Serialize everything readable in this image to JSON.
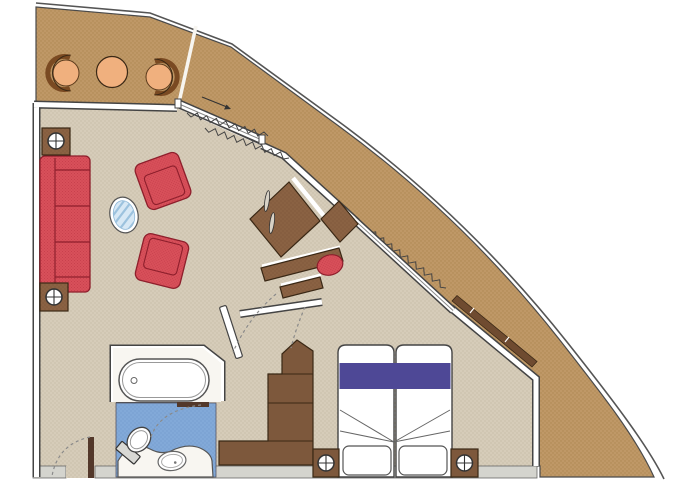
{
  "plan": {
    "kind": "cruise-ship-suite-floor-plan",
    "areas": [
      "balcony",
      "living-room",
      "bedroom",
      "bathroom",
      "entry"
    ],
    "inventory": [
      "balcony-chair",
      "balcony-chair",
      "balcony-table",
      "sofa",
      "end-table",
      "end-table",
      "armchair",
      "armchair",
      "coffee-table",
      "sliding-glass-door",
      "curtains",
      "window",
      "window-sill",
      "tv-cabinet",
      "side-cabinet",
      "desk",
      "desk-stool",
      "interior-door",
      "wardrobe",
      "bathtub",
      "toilet",
      "washbasin",
      "vanity-counter",
      "bathroom-door",
      "double-bed",
      "pillow",
      "pillow",
      "nightstand",
      "nightstand",
      "entry-door",
      "lamp-symbol",
      "lamp-symbol",
      "lamp-symbol",
      "lamp-symbol"
    ]
  },
  "colors": {
    "page_bg": "#FFFFFF",
    "hull": "#BF9867",
    "hull_dot": "#AE8751",
    "hull_outline": "#4A4A4A",
    "outer_line": "#555555",
    "floor": "#D6CCB9",
    "floor_dot": "#C5B9A2",
    "wall_core": "#FFFFFF",
    "wall_edge": "#444444",
    "bottom_wall": "#D4D4CE",
    "bath_nook": "#F8F6F1",
    "bath_floor": "#82A9D8",
    "bath_floor_dot": "#7299C9",
    "fixture_white": "#FFFFFF",
    "red": "#D8505A",
    "red_dot": "#C63E4B",
    "red_line": "#8E1F2C",
    "wood": "#8A6243",
    "wood_dot": "#7B5538",
    "wood_edge": "#3A2815",
    "wardrobe": "#7D583C",
    "sill": "#6F4B30",
    "bed_stripe": "#4E4896",
    "peach": "#F0B07E",
    "chair_back": "#7A4A22",
    "glass": "#D7E8F5",
    "glass_edge": "#8FB8D8",
    "glass_stripe": "#9CC2DE",
    "arc_dash": "#8A8A8A",
    "door_leaf": "#53382A",
    "handle_metal": "#D8D2C6"
  }
}
